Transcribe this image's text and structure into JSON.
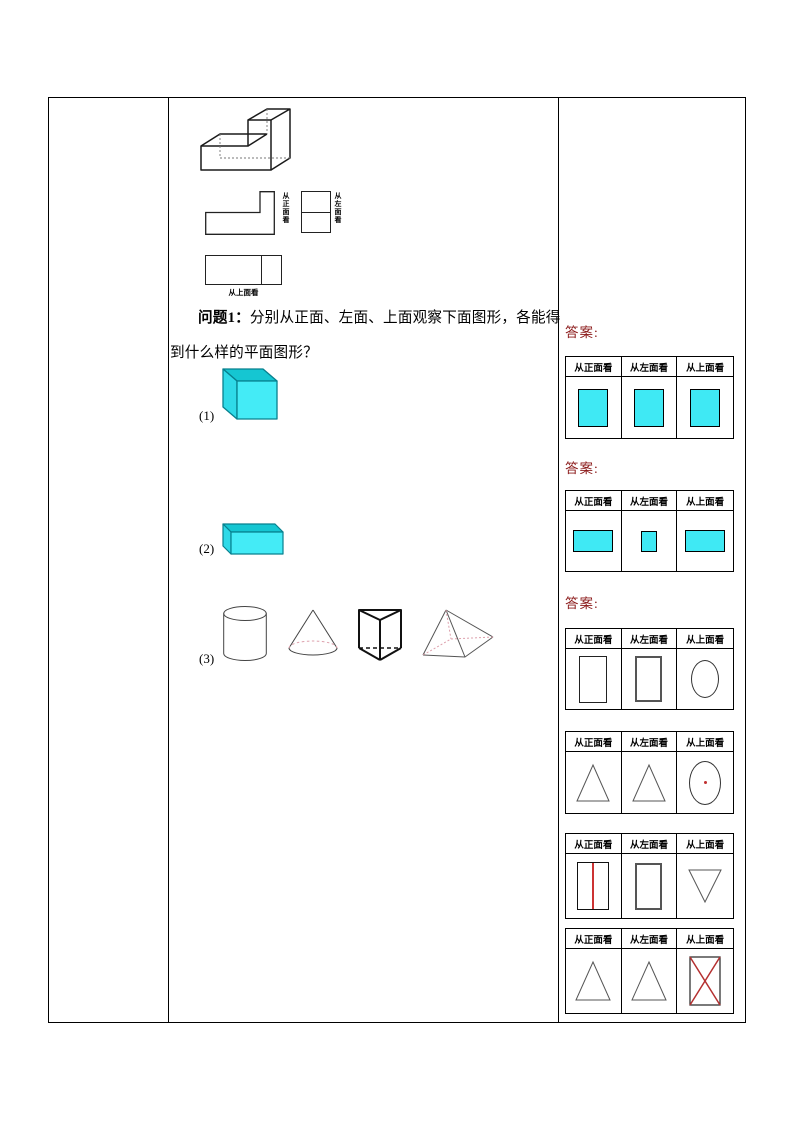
{
  "problem": {
    "label": "问题1：",
    "text_line1": "分别从正面、左面、上面观察下面图形，各能得",
    "text_line2": "到什么样的平面图形？"
  },
  "view_labels": {
    "front": "从正面看",
    "left": "从左面看",
    "top": "从上面看"
  },
  "items": {
    "item1": "(1)",
    "item2": "(2)",
    "item3": "(3)"
  },
  "answers": {
    "label": "答案:",
    "headers": [
      "从正面看",
      "从左面看",
      "从上面看"
    ],
    "tables": [
      {
        "subject": "cube",
        "cells": [
          "cyan-square",
          "cyan-square",
          "cyan-square"
        ]
      },
      {
        "subject": "cuboid",
        "cells": [
          "cyan-wide-rectangle",
          "cyan-small-rectangle",
          "cyan-wide-rectangle"
        ]
      },
      {
        "subject": "cylinder",
        "cells": [
          "rectangle-outline",
          "rectangle-outline",
          "ellipse-outline"
        ]
      },
      {
        "subject": "cone",
        "cells": [
          "triangle-outline",
          "triangle-outline",
          "ellipse-with-red-center-dot"
        ]
      },
      {
        "subject": "triangular-prism",
        "cells": [
          "rectangle-with-red-middle-line",
          "rectangle-outline",
          "inverted-triangle-outline"
        ]
      },
      {
        "subject": "pyramid",
        "cells": [
          "triangle-outline",
          "triangle-outline",
          "rectangle-with-red-diagonal-cross"
        ]
      }
    ]
  },
  "colors": {
    "cyan_front": "#3FE9F4",
    "cyan_top": "#15C6D2",
    "cyan_left": "#2FDAE8",
    "answer_label_red": "#8B1A1A",
    "mark_red": "#CC3333"
  }
}
